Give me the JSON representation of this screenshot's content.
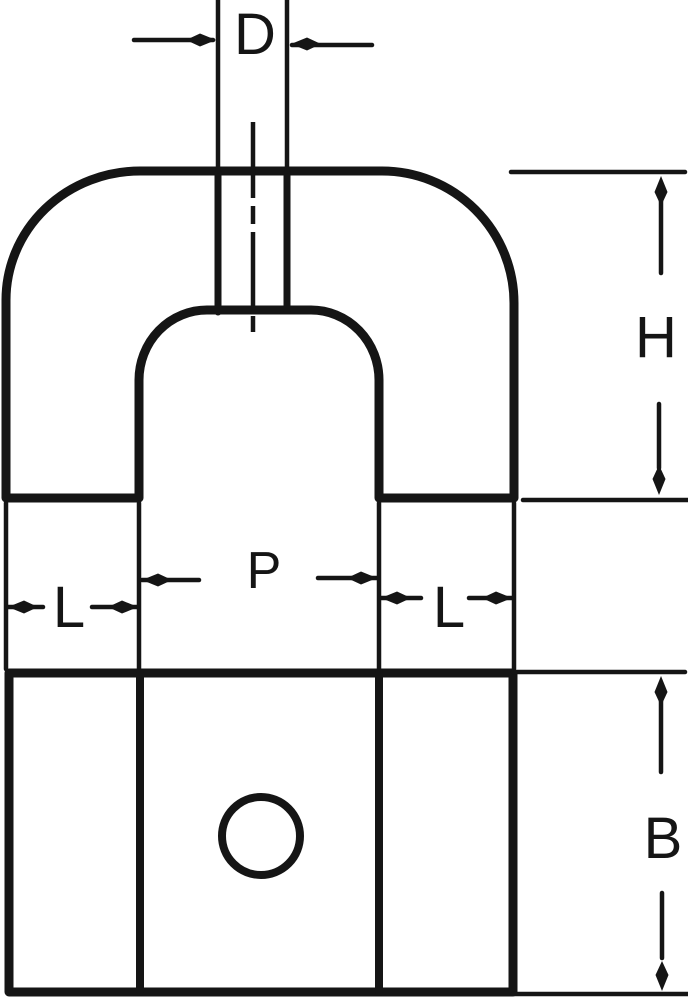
{
  "drawing": {
    "kind": "dimensioned technical drawing, horseshoe magnet, two views",
    "front_view": {
      "dim_stem_width": {
        "label": "D"
      },
      "dim_height": {
        "label": "H"
      },
      "dim_pole_gap": {
        "label": "P"
      },
      "dim_left_leg_width": {
        "label": "L"
      },
      "dim_right_leg_width": {
        "label": "L"
      }
    },
    "bottom_view": {
      "dim_depth": {
        "label": "B"
      }
    }
  },
  "colors": {
    "ink": "#151515",
    "background": "#ffffff"
  }
}
